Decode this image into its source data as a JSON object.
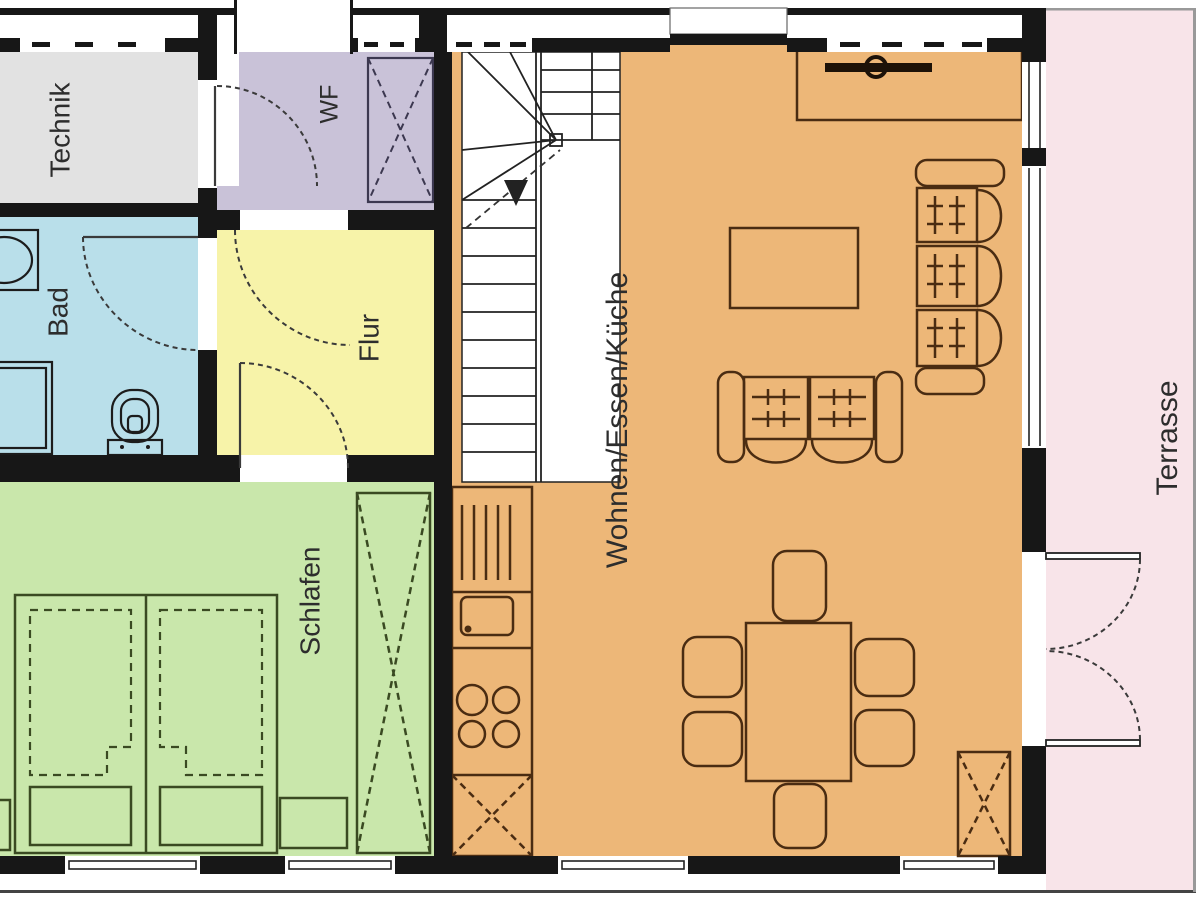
{
  "floor_plan": {
    "rooms": {
      "technik": {
        "label": "Technik",
        "color": "#e2e2e2"
      },
      "wf": {
        "label": "WF",
        "color": "#c9c2d8"
      },
      "bad": {
        "label": "Bad",
        "color": "#b9dfea"
      },
      "flur": {
        "label": "Flur",
        "color": "#f7f3a9"
      },
      "schlafen": {
        "label": "Schlafen",
        "color": "#c9e7ab"
      },
      "wohnen_essen_kueche": {
        "label": "Wohnen/Essen/Küche",
        "color": "#edb778"
      },
      "terrasse": {
        "label": "Terrasse",
        "color": "#f8e4e9"
      }
    },
    "colors": {
      "wall": "#171717",
      "stair_area": "#ffffff",
      "living_line": "#4a2c12",
      "bedroom_line": "#3a4a22",
      "fixture_line": "#1c1c1c",
      "door_line": "#3a3a3a",
      "stair_line": "#222222",
      "label_color": "#2d2d2d",
      "terrace_edge": "#999999",
      "sill_line": "#444444"
    }
  }
}
